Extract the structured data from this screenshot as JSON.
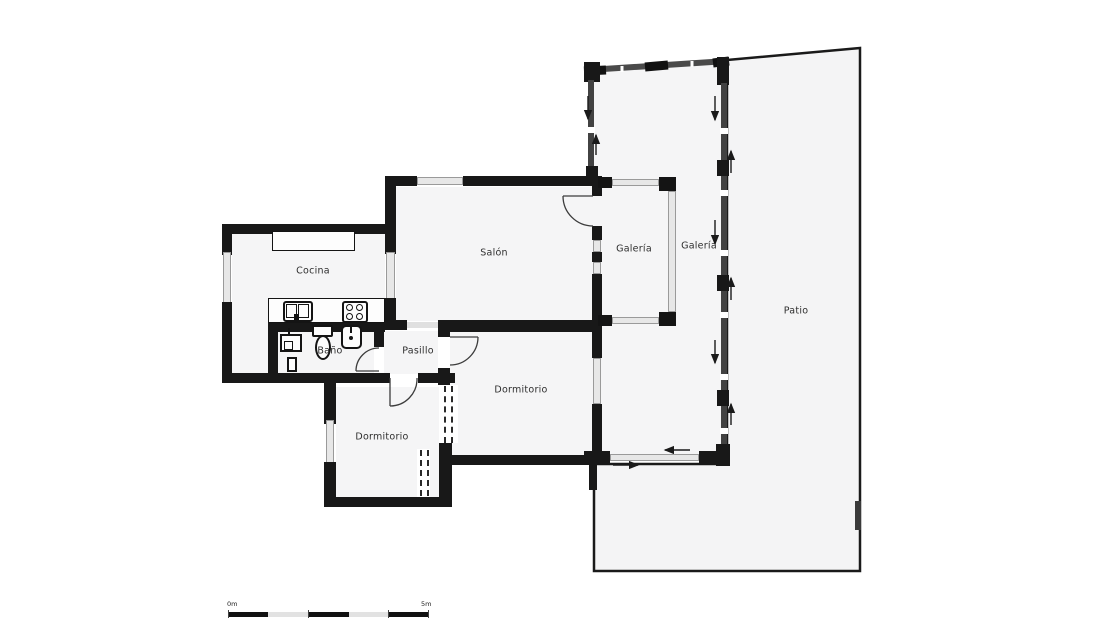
{
  "plan": {
    "title": "floor-plan",
    "rooms": [
      {
        "id": "cocina",
        "label": "Cocina"
      },
      {
        "id": "salon",
        "label": "Salón"
      },
      {
        "id": "galeria_inner",
        "label": "Galería"
      },
      {
        "id": "galeria_outer",
        "label": "Galería"
      },
      {
        "id": "patio",
        "label": "Patio"
      },
      {
        "id": "bano",
        "label": "Baño"
      },
      {
        "id": "pasillo",
        "label": "Pasillo"
      },
      {
        "id": "dormitorio_grande",
        "label": "Dormitorio"
      },
      {
        "id": "dormitorio_pequeno",
        "label": "Dormitorio"
      }
    ],
    "fixtures": [
      "kitchen-counter",
      "kitchen-sink",
      "stove",
      "bath-basin",
      "toilet",
      "washbasin",
      "bath-column"
    ],
    "scale_bar": {
      "start": "0m",
      "end": "5m"
    },
    "colors": {
      "wall": "#181818",
      "window": "#e7e7e7",
      "floor": "#f5f5f6",
      "text": "#2e2e2e"
    }
  }
}
